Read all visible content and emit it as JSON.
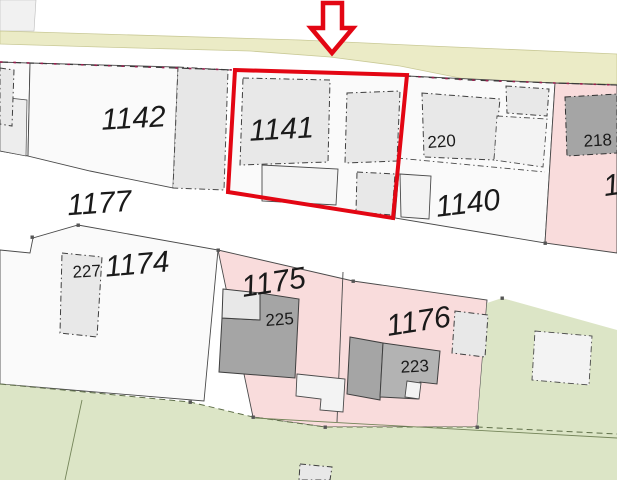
{
  "map_type": "cadastral-parcel-map",
  "colors": {
    "background": "#ffffff",
    "road_yellow": "#ebebc6",
    "road_yellow_border": "#c9c996",
    "parcel_white": "#fafafa",
    "parcel_pink": "#f9dcdc",
    "area_green": "#dce5c6",
    "building_light": "#e8e8e8",
    "building_mid": "#b3b3b3",
    "building_dark": "#a5a5a5",
    "boundary_dark": "#4a4a4a",
    "boundary_red_dots": "#9c1d4e",
    "highlight_red": "#e30613",
    "arrow_fill": "#ffffff",
    "label_color": "#1a1a1a"
  },
  "labels": {
    "p1142": {
      "text": "1142"
    },
    "p1141": {
      "text": "1141"
    },
    "p1177": {
      "text": "1177"
    },
    "p1140": {
      "text": "1140"
    },
    "p1174": {
      "text": "1174"
    },
    "p1175": {
      "text": "1175"
    },
    "p1176": {
      "text": "1176"
    },
    "p_right_partial": {
      "text": "1"
    },
    "b220": {
      "text": "220"
    },
    "b218": {
      "text": "218"
    },
    "b227": {
      "text": "227"
    },
    "b225": {
      "text": "225"
    },
    "b223": {
      "text": "223"
    }
  },
  "highlight": {
    "selected_parcel": "1141",
    "marker": "red-down-arrow"
  }
}
